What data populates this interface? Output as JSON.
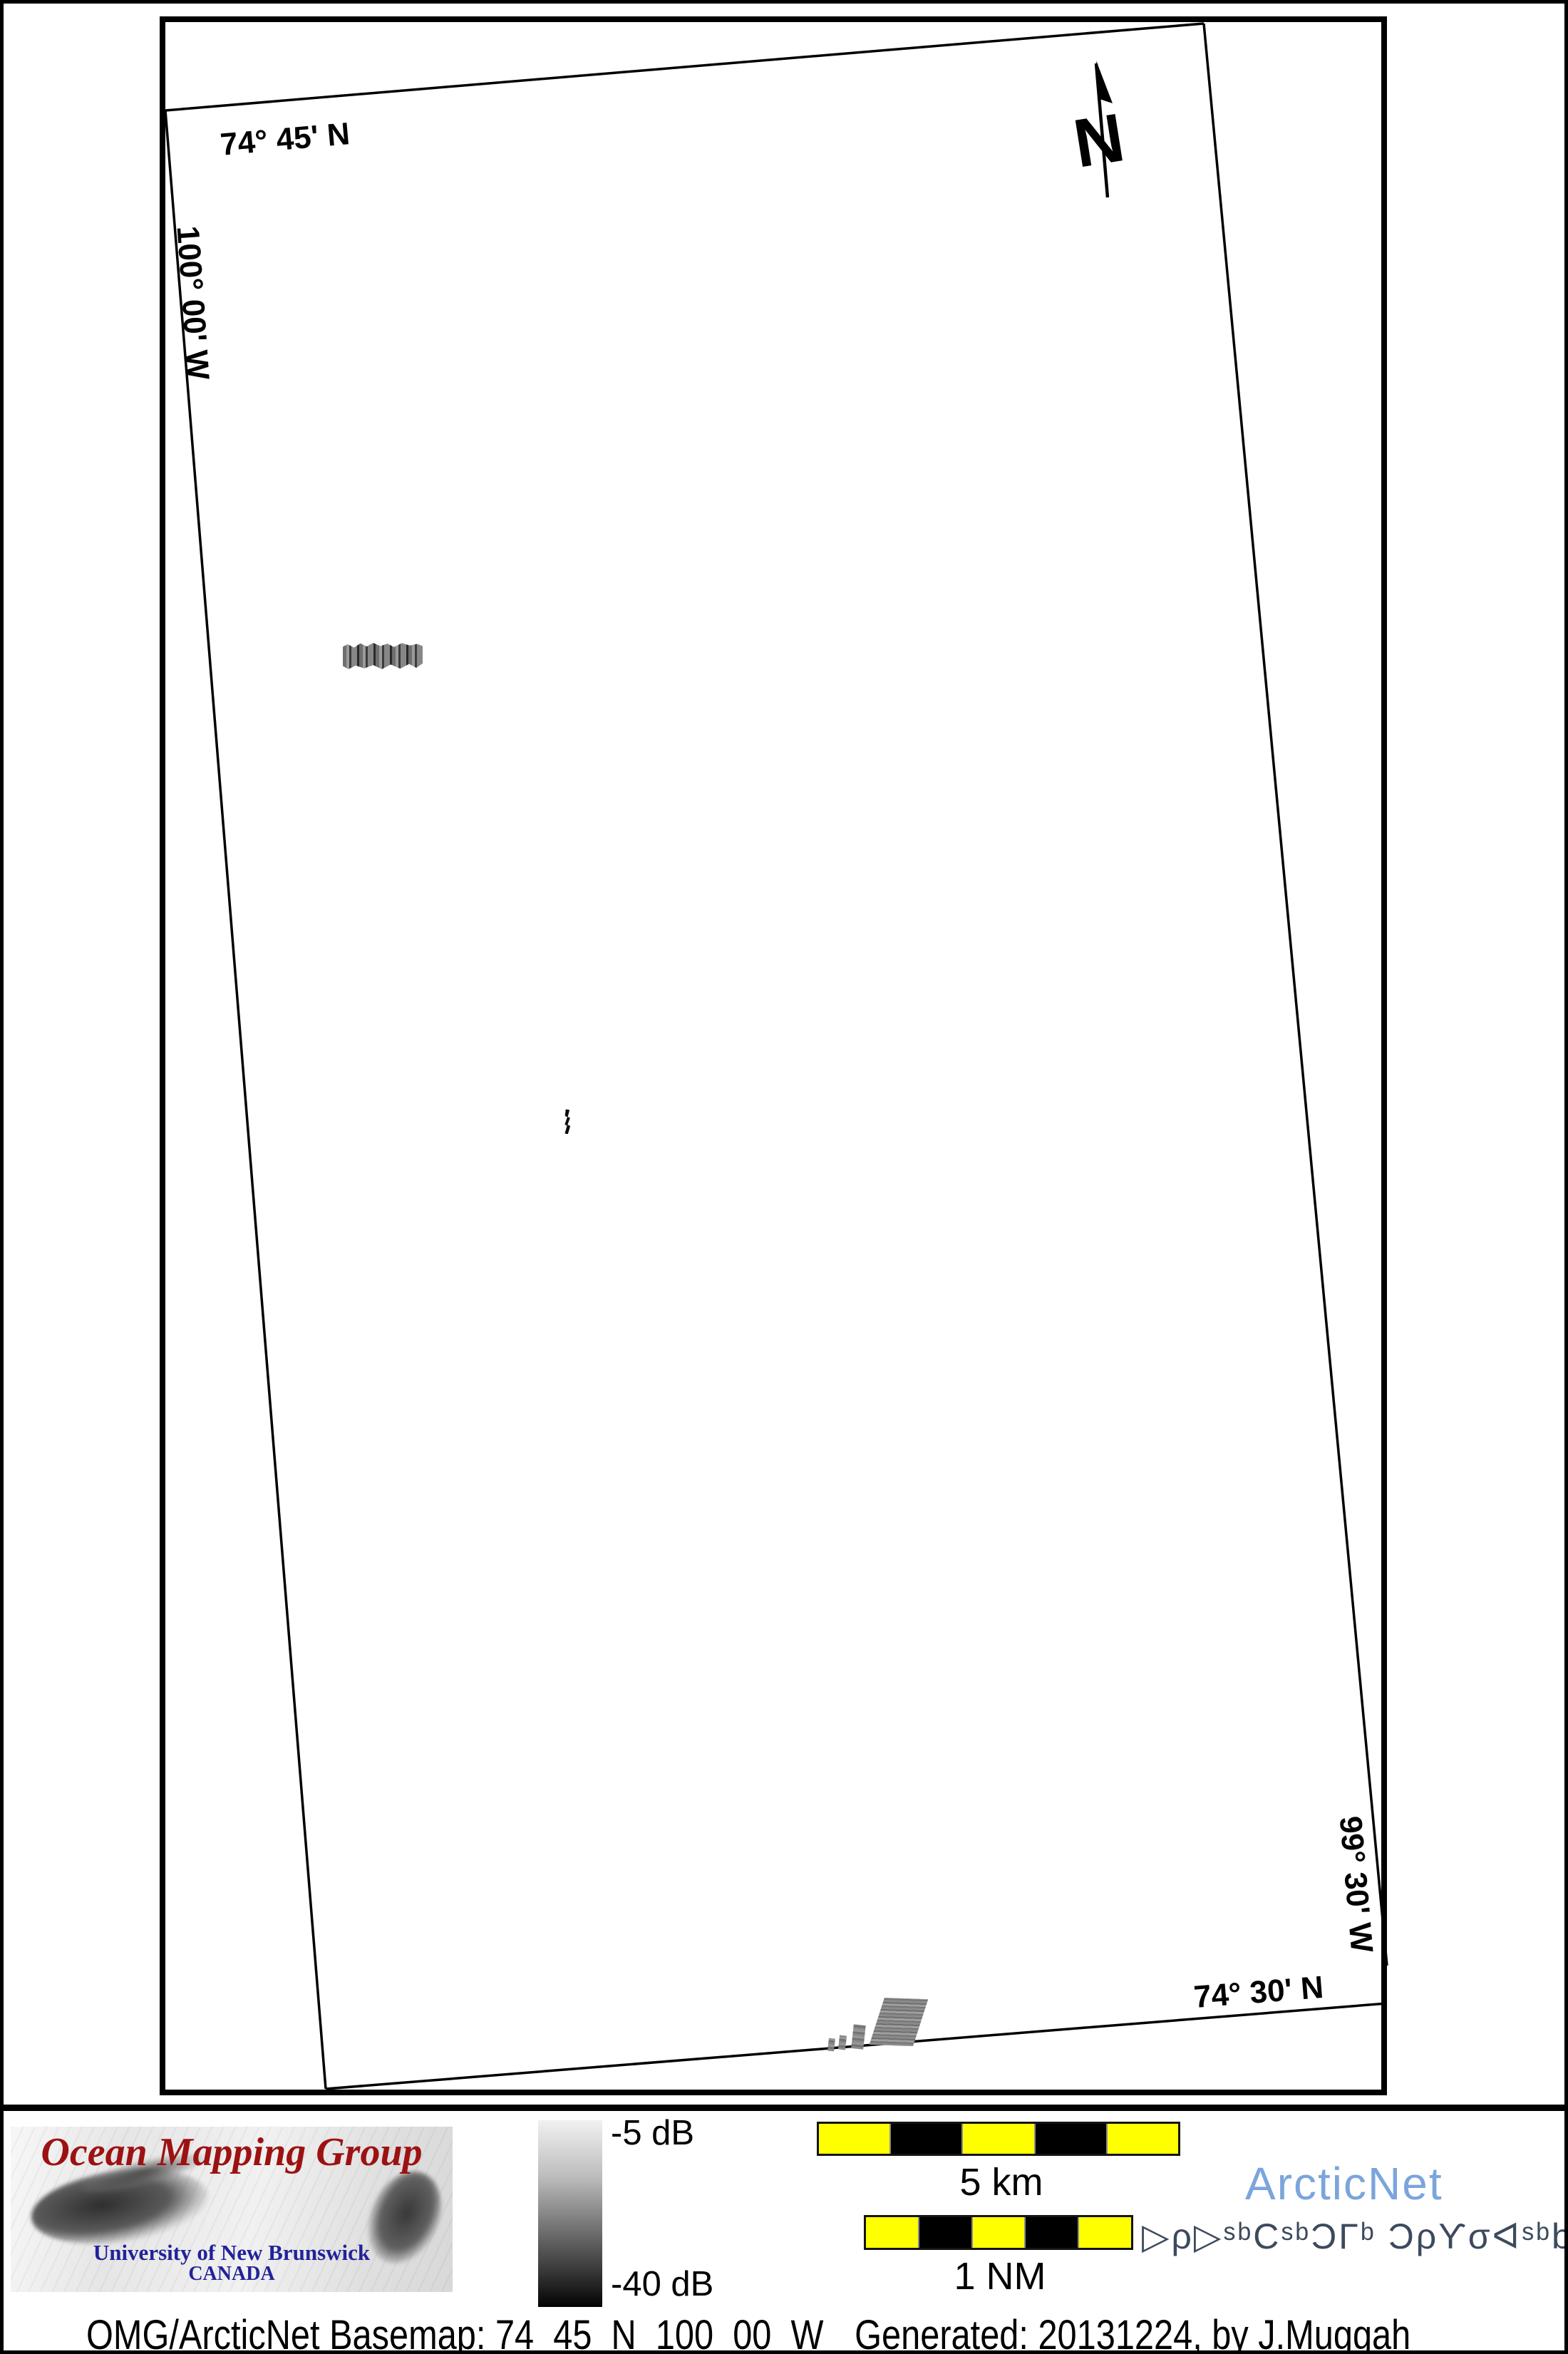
{
  "map": {
    "labels": {
      "top_lat": "74° 45' N",
      "left_lon": "100° 00' W",
      "right_lon": "99° 30' W",
      "bottom_lat": "74° 30' N"
    },
    "north_arrow": {
      "label": "N"
    }
  },
  "legend": {
    "top_label": "-5 dB",
    "bottom_label": "-40 dB"
  },
  "scale_bars": {
    "km": {
      "label": "5 km",
      "segments": 5
    },
    "nm": {
      "label": "1 NM",
      "segments": 5
    }
  },
  "branding": {
    "omg": {
      "title": "Ocean Mapping Group",
      "subtitle": "University of New Brunswick",
      "country": "CANADA"
    },
    "arcticnet": {
      "wordmark": "ArcticNet",
      "inuktitut": "ᐅᑭᐅᖅᑕᖅᑐᒥᒃ ᑐᑭᓯᓂᐊᖅᑲᑎᒌᑦ",
      "inuktitut_display": "▷ρ▷ˢᵇCˢᵇƆΓᵇ Ɔρϒσᐊˢᵇb∩Γ̇ᶜ"
    }
  },
  "caption": {
    "basemap": "OMG/ArcticNet Basemap: 74_45_N_100_00_W",
    "generated": "Generated: 20131224, by J.Muggah"
  },
  "colors": {
    "scalebar_yellow": "#ffff00",
    "arcticnet_blue": "#7ba5db",
    "omg_red": "#9c1212",
    "unb_blue": "#22229a",
    "inuktitut_slate": "#3c4a5e"
  }
}
